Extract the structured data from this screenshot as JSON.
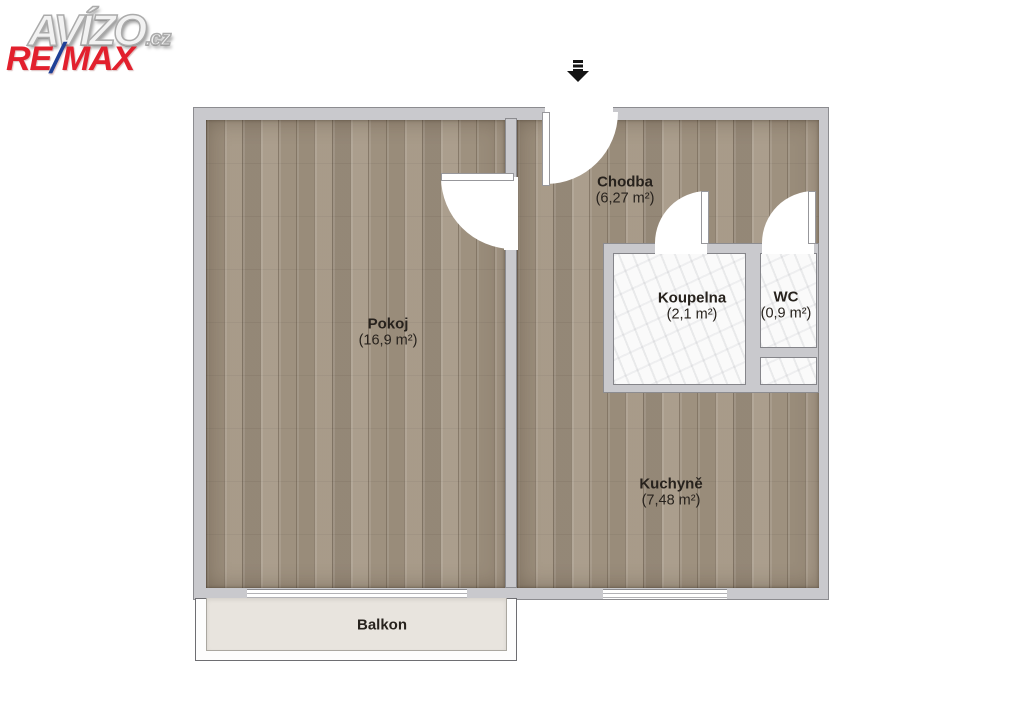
{
  "logos": {
    "avizo": {
      "text": "AVÍZO",
      "suffix": ".cz"
    },
    "remax": {
      "re": "RE",
      "slash": "/",
      "max": "MAX",
      "red": "#e2202d",
      "blue": "#1f4096"
    }
  },
  "entrance": {
    "arrow_icon": "entrance-arrow-down"
  },
  "rooms": [
    {
      "id": "pokoj",
      "name": "Pokoj",
      "area": "(16,9 m²)"
    },
    {
      "id": "chodba",
      "name": "Chodba",
      "area": "(6,27 m²)"
    },
    {
      "id": "koupelna",
      "name": "Koupelna",
      "area": "(2,1 m²)"
    },
    {
      "id": "wc",
      "name": "WC",
      "area": "(0,9 m²)"
    },
    {
      "id": "kuchyne",
      "name": "Kuchyně",
      "area": "(7,48 m²)"
    },
    {
      "id": "balkon",
      "name": "Balkon"
    }
  ],
  "colors": {
    "wall": "#c9c9cd",
    "wall_outline": "#8c8c90",
    "wood_floor": "#a29584",
    "marble_floor": "#fafafa",
    "balcony_floor": "#e8e4de",
    "label_text": "#27221d",
    "arrow": "#141414"
  }
}
